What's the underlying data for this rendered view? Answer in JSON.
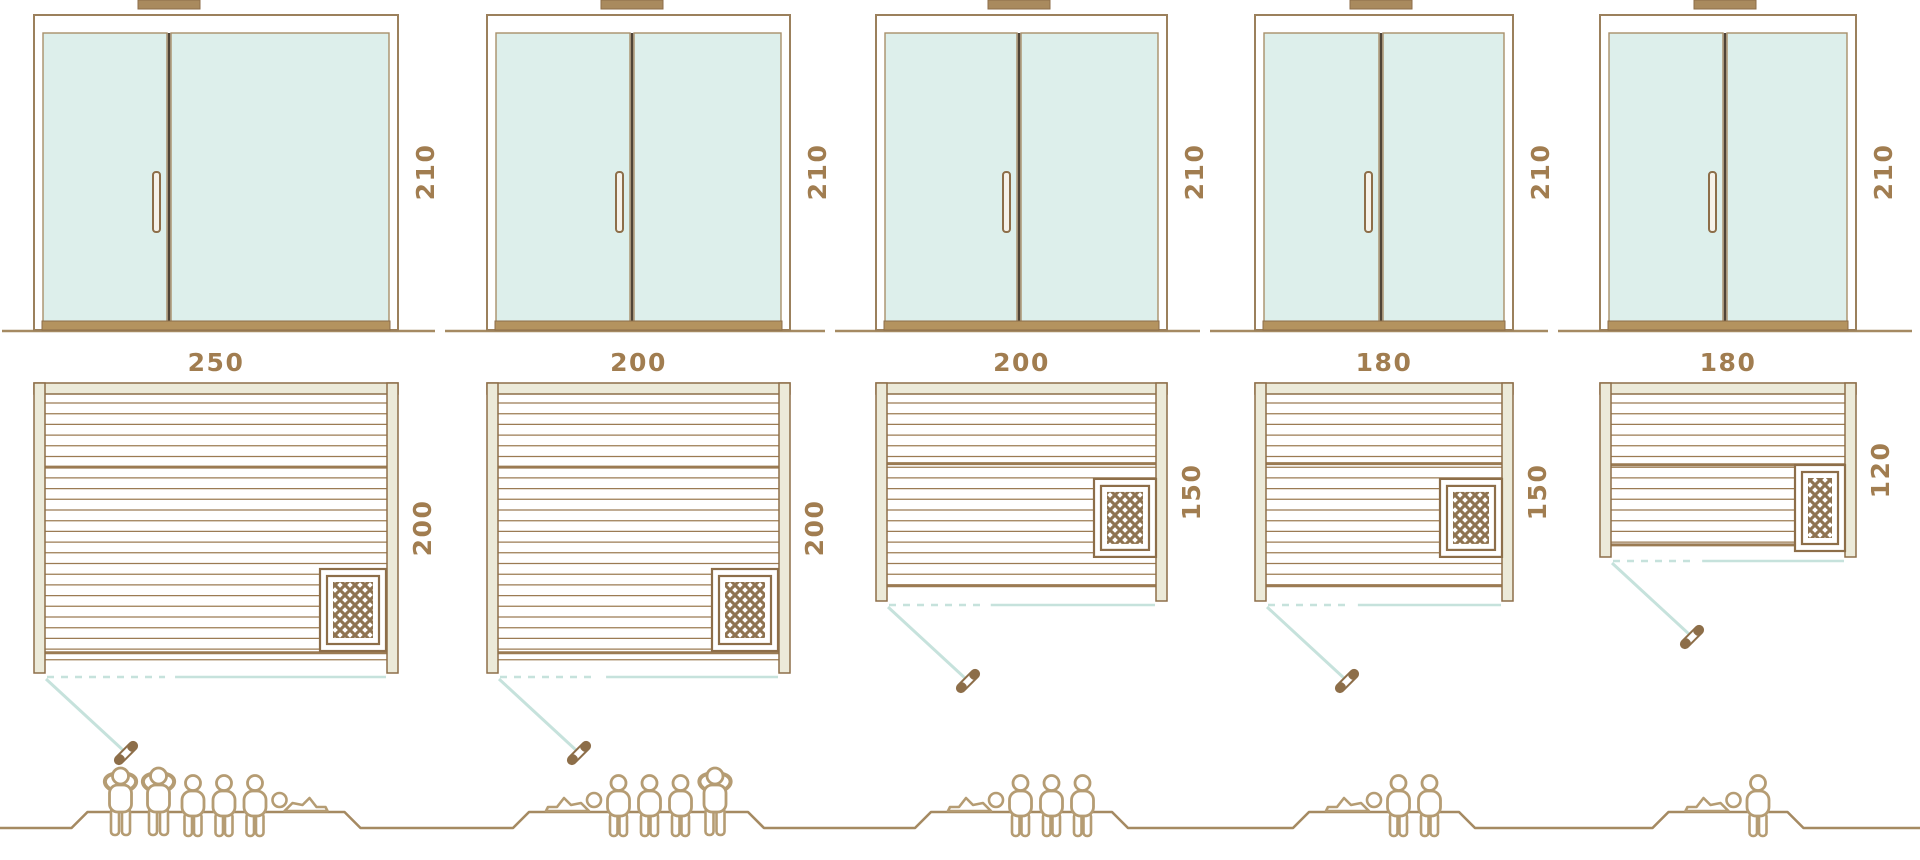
{
  "diagram": {
    "kind": "sauna-size-comparison",
    "rows": [
      "door-elevations",
      "floor-plans",
      "capacity-figures"
    ],
    "saunas": [
      {
        "height_label": "210",
        "width_label": "250",
        "depth_label": "200",
        "height_cm": 210,
        "width_cm": 250,
        "depth_cm": 200,
        "heater_position": "bottom-right-corner",
        "door_swing": "bottom-left-outward",
        "capacity": {
          "total": 6,
          "standing": 2,
          "sitting": 3,
          "lying": 1,
          "icons": [
            "person-standing",
            "person-standing",
            "person-sitting",
            "person-sitting",
            "person-sitting",
            "person-lying"
          ]
        }
      },
      {
        "height_label": "210",
        "width_label": "200",
        "depth_label": "200",
        "height_cm": 210,
        "width_cm": 200,
        "depth_cm": 200,
        "heater_position": "bottom-right-corner",
        "door_swing": "bottom-left-outward",
        "capacity": {
          "total": 5,
          "standing": 1,
          "sitting": 3,
          "lying": 1,
          "icons": [
            "person-lying",
            "person-sitting",
            "person-sitting",
            "person-sitting",
            "person-standing"
          ]
        }
      },
      {
        "height_label": "210",
        "width_label": "200",
        "depth_label": "150",
        "height_cm": 210,
        "width_cm": 200,
        "depth_cm": 150,
        "heater_position": "right-middle",
        "door_swing": "bottom-left-outward",
        "capacity": {
          "total": 4,
          "standing": 0,
          "sitting": 3,
          "lying": 1,
          "icons": [
            "person-lying",
            "person-sitting",
            "person-sitting",
            "person-sitting"
          ]
        }
      },
      {
        "height_label": "210",
        "width_label": "180",
        "depth_label": "150",
        "height_cm": 210,
        "width_cm": 180,
        "depth_cm": 150,
        "heater_position": "right-middle",
        "door_swing": "bottom-left-outward",
        "capacity": {
          "total": 3,
          "standing": 0,
          "sitting": 2,
          "lying": 1,
          "icons": [
            "person-lying",
            "person-sitting",
            "person-sitting"
          ]
        }
      },
      {
        "height_label": "210",
        "width_label": "180",
        "depth_label": "120",
        "height_cm": 210,
        "width_cm": 180,
        "depth_cm": 120,
        "heater_position": "bottom-right-corner",
        "door_swing": "bottom-left-outward",
        "capacity": {
          "total": 2,
          "standing": 0,
          "sitting": 1,
          "lying": 1,
          "icons": [
            "person-lying",
            "person-sitting"
          ]
        }
      }
    ],
    "colors": {
      "outline_brown": "#8d6e49",
      "slat_brown": "#9b7b53",
      "frame_beige": "#ecead9",
      "glass_teal": "#ddefeb",
      "glass_edge": "#a8906a",
      "swing_teal": "#c6e2dc",
      "label_brown": "#a17d50",
      "people_tan": "#b59c73",
      "divider_dark": "#4f4437",
      "ground_brown": "#a58a62",
      "cap_brown": "#a98a5e",
      "sill_brown": "#b4935f",
      "handle_fill": "#f6f2e9"
    }
  }
}
